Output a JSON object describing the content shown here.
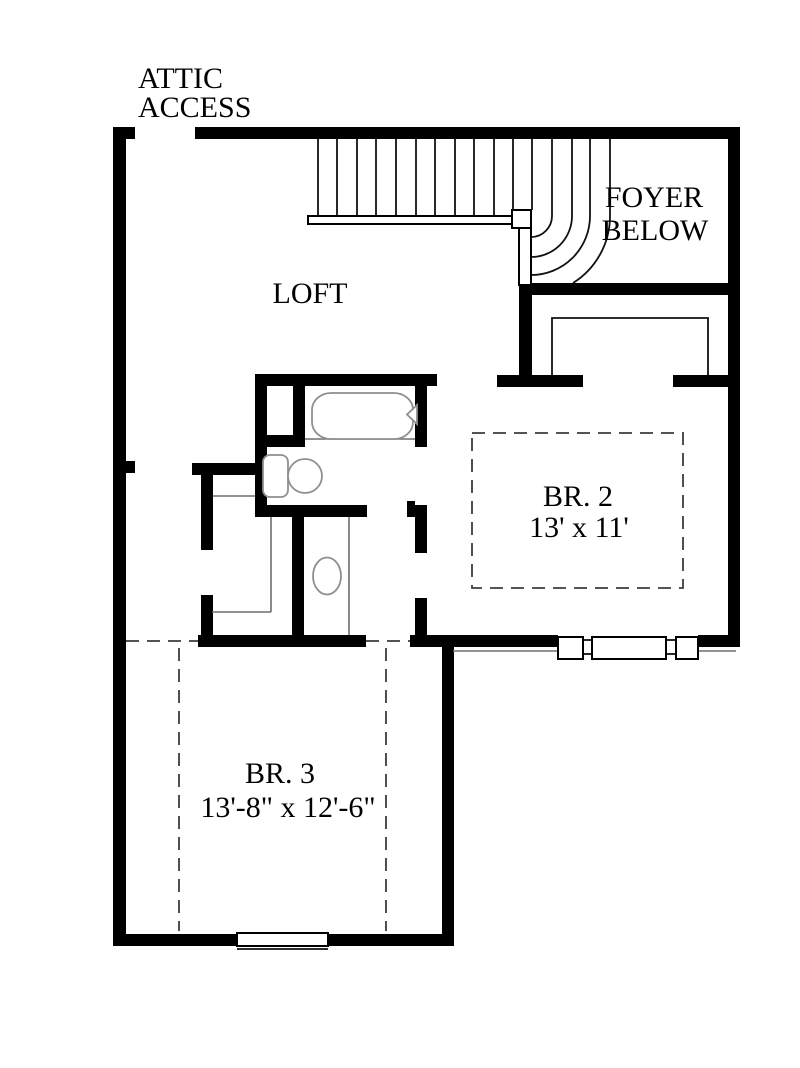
{
  "document": {
    "kind": "architectural floor plan, upper level"
  },
  "labels": {
    "attic_access": {
      "line1": "ATTIC",
      "line2": "ACCESS"
    },
    "foyer": {
      "line1": "FOYER",
      "line2": "BELOW"
    },
    "loft": {
      "name": "LOFT"
    },
    "bedroom2": {
      "name": "BR. 2",
      "dimensions": "13' x 11'"
    },
    "bedroom3": {
      "name": "BR. 3",
      "dimensions": "13'-8\" x 12'-6\""
    }
  },
  "symbols": {
    "staircase": "staircase-with-winder-treads",
    "handrail": "stair-handrail",
    "bathtub": "bathtub-symbol",
    "toilet": "toilet-symbol",
    "sink": "oval-sink-symbol",
    "windows": "window-symbols-in-exterior-walls",
    "dashed_areas": "ceiling-break-dashed-lines"
  },
  "colors": {
    "background": "#ffffff",
    "walls": "#000000",
    "fixtures": "#8f8f8f",
    "thin_lines": "#6e6e6e",
    "dashed_lines": "#3c3c3c",
    "text": "#000000"
  }
}
